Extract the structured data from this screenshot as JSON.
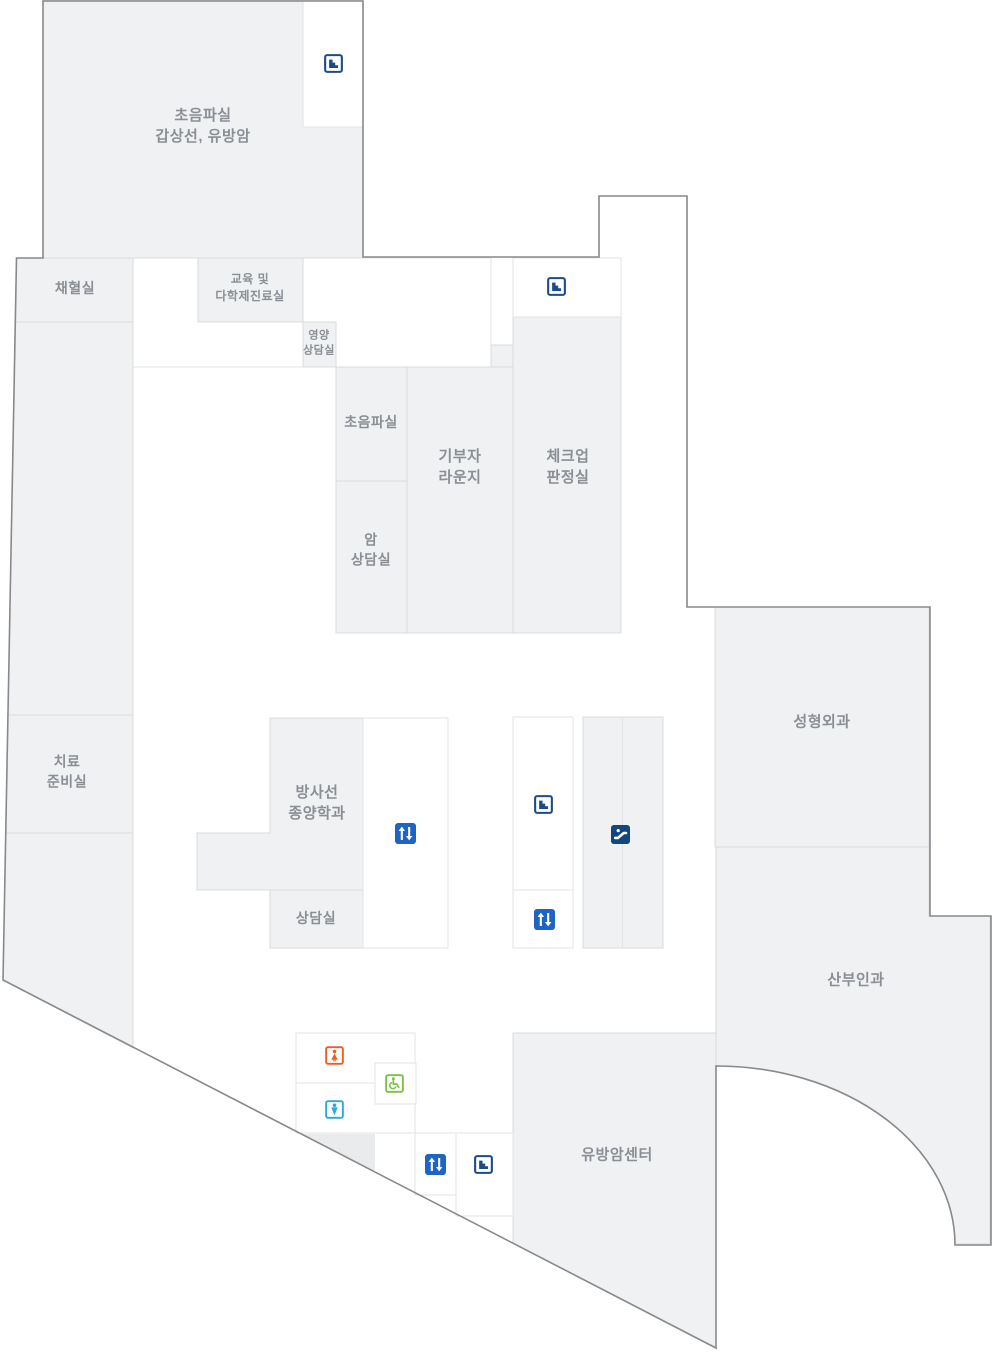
{
  "map_title": "암센터 층별 안내도",
  "rooms": [
    {
      "id": "ultrasound-thyroid-breast",
      "label": "초음파실\n갑상선, 유방암"
    },
    {
      "id": "blood-collection",
      "label": "채혈실"
    },
    {
      "id": "education-multidisciplinary",
      "label": "교육 및\n다학제진료실"
    },
    {
      "id": "nutrition-counseling",
      "label": "영양\n상담실"
    },
    {
      "id": "ultrasound",
      "label": "초음파실"
    },
    {
      "id": "cancer-counseling",
      "label": "암\n상담실"
    },
    {
      "id": "donor-lounge",
      "label": "기부자\n라운지"
    },
    {
      "id": "checkup-judgement",
      "label": "체크업\n판정실"
    },
    {
      "id": "treatment-prep",
      "label": "치료\n준비실"
    },
    {
      "id": "radiation-oncology",
      "label": "방사선\n종양학과"
    },
    {
      "id": "counseling",
      "label": "상담실"
    },
    {
      "id": "plastic-surgery",
      "label": "성형외과"
    },
    {
      "id": "obgyn",
      "label": "산부인과"
    },
    {
      "id": "breast-cancer-center",
      "label": "유방암센터"
    }
  ],
  "icons": {
    "stairs": "stairs-icon",
    "elevator": "elevator-icon",
    "escalator": "escalator-icon",
    "restroom_female": "female-restroom-icon",
    "restroom_male": "male-restroom-icon",
    "wheelchair": "wheelchair-accessible-icon"
  },
  "colors": {
    "room_fill": "#f0f1f3",
    "room_border": "#d9dbde",
    "building_outline": "#87898c",
    "label_text": "#8a8f95",
    "stairs_navy": "#1b4c86",
    "elevator_blue": "#1d64c4",
    "escalator_navy": "#12477e",
    "female_orange": "#f15a24",
    "male_blue": "#2aa9e0",
    "wheelchair_green": "#7cc142"
  }
}
